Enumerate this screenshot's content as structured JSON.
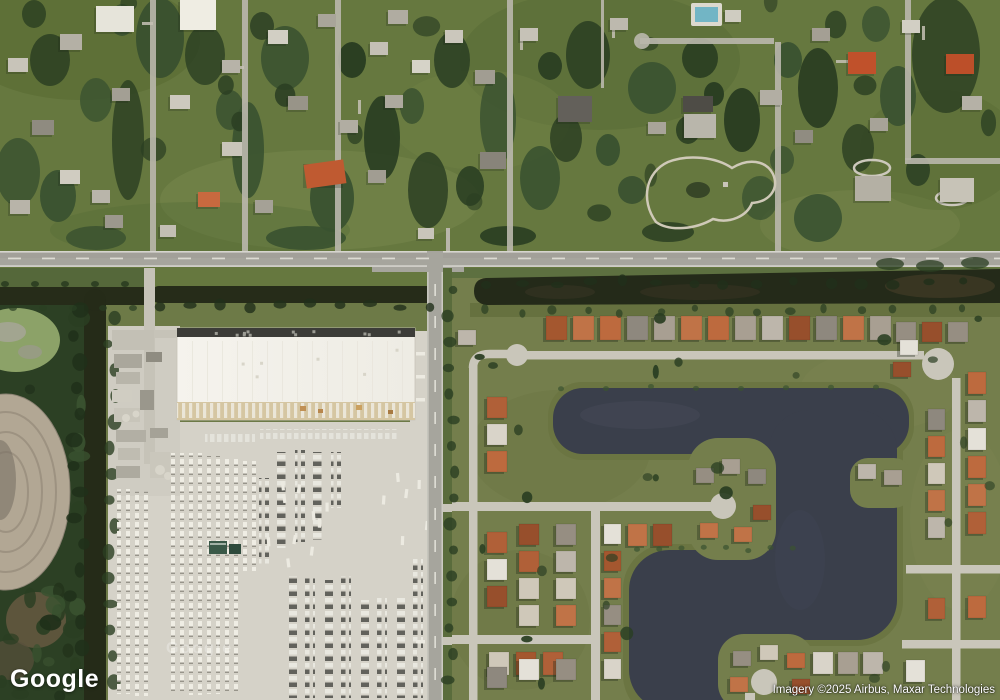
{
  "window": {
    "width": 1000,
    "height": 700
  },
  "map": {
    "view_type": "satellite",
    "logo_text": "Google",
    "watermark_text": "Google",
    "attribution_text": "Imagery ©2025 Airbus, Maxar Technologies"
  },
  "scene": {
    "areas": {
      "north": "suburban residential lots with heavy tree cover",
      "southwest": "distribution warehouse with trailer and car parking lots",
      "southeast": "planned residential community around irregular lakes",
      "west": "wetland strip with retention pond, dirt oval and drainage canal"
    },
    "palette": {
      "grass_north": "#66783f",
      "grass_east": "#747e4c",
      "grass_verge": "#5d7040",
      "tree_dark": "#2a3e22",
      "tree_mid": "#3a5230",
      "tree_deep": "#20301a",
      "canal_water": "#242a19",
      "canal_brown": "#4a3f2a",
      "lake_water": "#3a3f4b",
      "lake_light": "#454a57",
      "lake_bank": "#6b7542",
      "road_asphalt": "#a6a59d",
      "road_line": "#e9e8e2",
      "street_concrete": "#c9c6ba",
      "lot_concrete": "#d5d2c8",
      "warehouse_roof": "#f2f0e9",
      "warehouse_edge": "#3c3c38",
      "dock_apron": "#d5c6a2",
      "dirt_oval": "#b2a794",
      "pond_algae": "#8ca268",
      "roof_orange": [
        "#b06038",
        "#c07347",
        "#a4572f",
        "#bd6a3e",
        "#974f2c"
      ],
      "roof_gray": [
        "#a89f92",
        "#968e82",
        "#bdb6ab",
        "#8e887e"
      ],
      "roof_light": [
        "#d9d4c9",
        "#cfc8b9",
        "#e4e1d8"
      ],
      "vehicle_light": "#eceae1",
      "vehicle_dark": "#62625c",
      "shadow": "#1c2415"
    }
  }
}
